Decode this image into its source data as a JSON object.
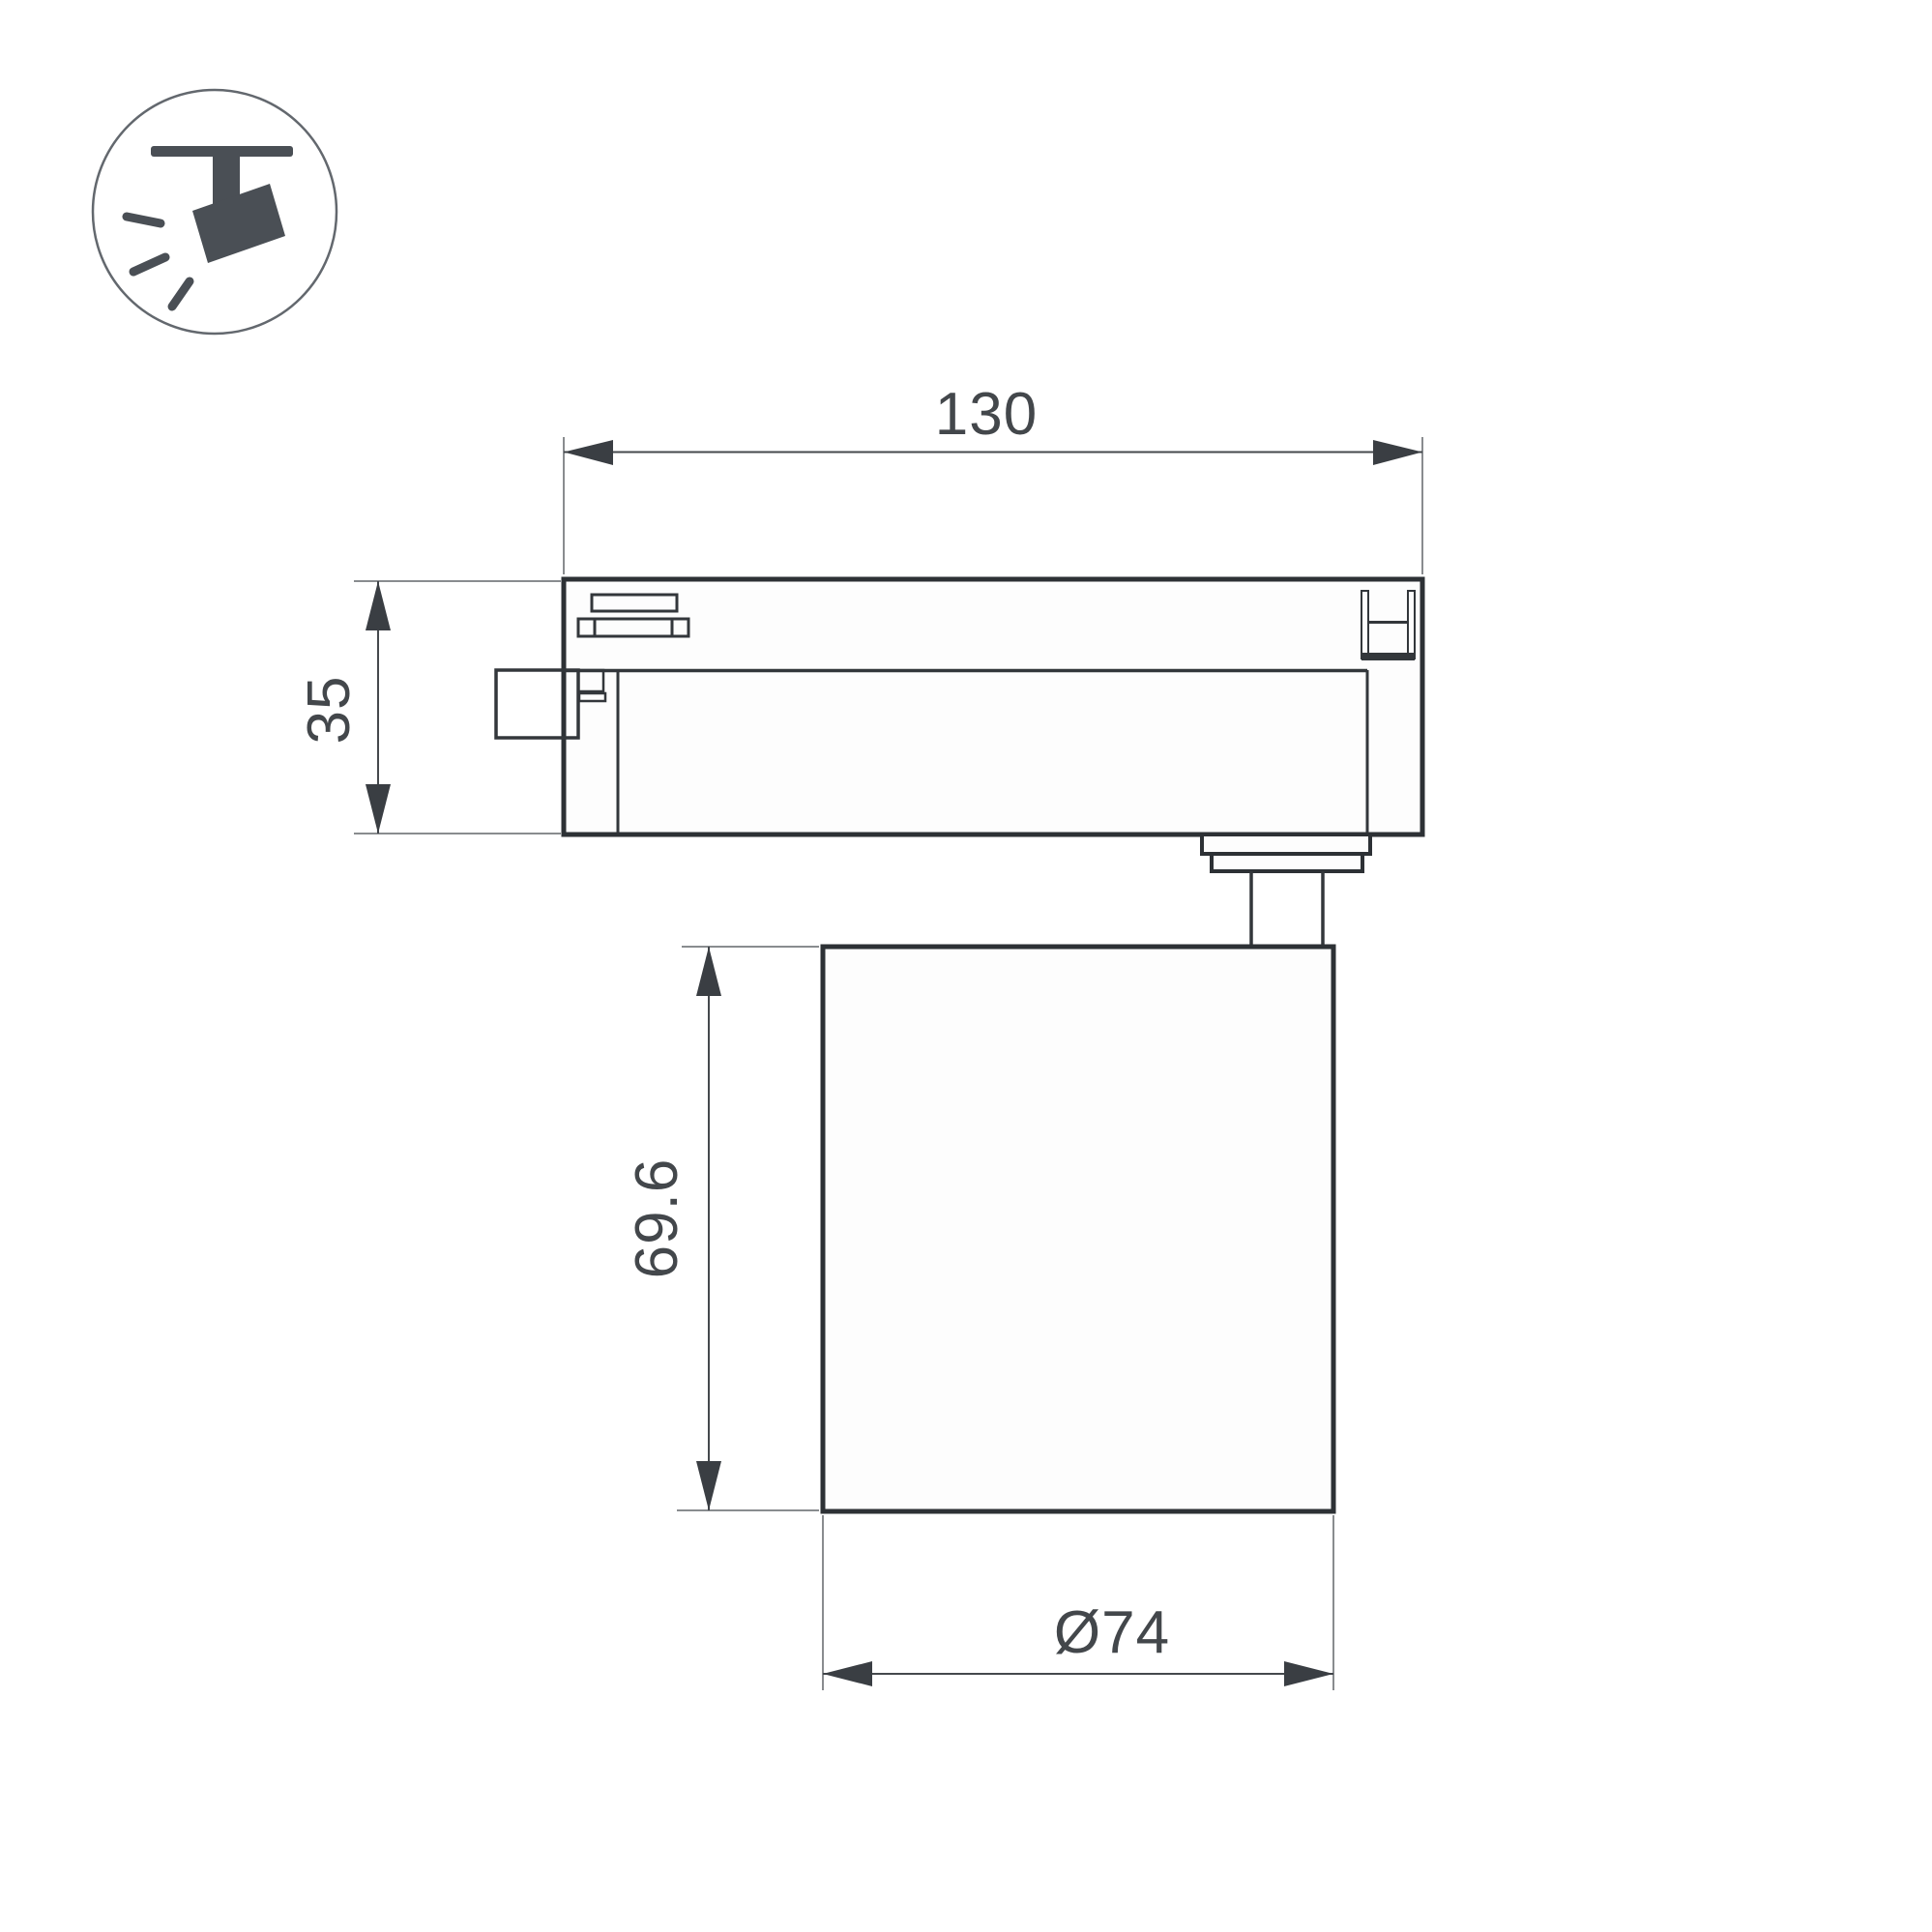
{
  "drawing": {
    "type": "technical-dimension-drawing",
    "subject": "track-mounted spotlight luminaire, side view",
    "icon": {
      "name": "track-spotlight-icon"
    },
    "dimensions": {
      "track_width": {
        "label": "130"
      },
      "adapter_height": {
        "label": "35"
      },
      "body_height": {
        "label": "69.6"
      },
      "body_diameter": {
        "label": "Ø74"
      }
    }
  },
  "colors": {
    "bg": "#ffffff",
    "surface": "#fdfdfd",
    "outline": "#2d3135",
    "detail": "#33373b",
    "dim": "#45494d",
    "ext": "#898c8f",
    "arrow": "#3a3e43",
    "text": "#43474b",
    "icon": "#4a4f55",
    "ring": "#63686e"
  }
}
